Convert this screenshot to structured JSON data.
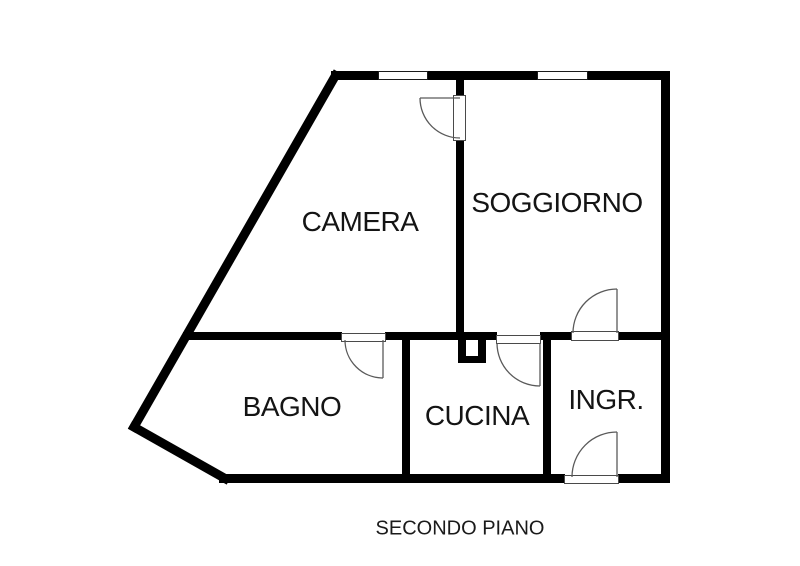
{
  "caption": "SECONDO PIANO",
  "rooms": {
    "camera": "CAMERA",
    "soggiorno": "SOGGIORNO",
    "bagno": "BAGNO",
    "cucina": "CUCINA",
    "ingresso": "INGR."
  },
  "features": {
    "windows": [
      "window-top-left",
      "window-top-right"
    ],
    "doors": [
      "door-camera",
      "door-soggiorno-ingresso",
      "door-bagno",
      "door-cucina",
      "door-entrance"
    ]
  },
  "colors": {
    "wall": "#000000",
    "background": "#ffffff",
    "door_line": "#5a5a5a",
    "text": "#141414"
  }
}
